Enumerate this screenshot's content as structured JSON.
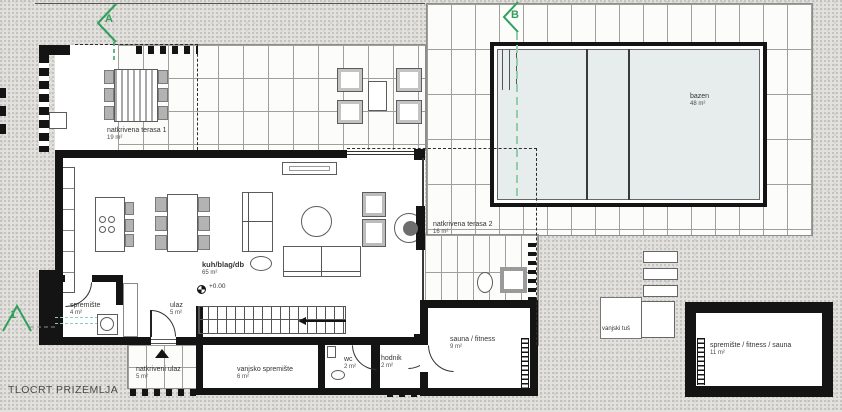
{
  "drawing": {
    "title": "TLOCRT PRIZEMLJA",
    "elevation_label": "+0.00"
  },
  "section_markers": {
    "a": "A",
    "b": "B",
    "one": "1"
  },
  "rooms": {
    "terasa1": {
      "name": "natkrivena terasa 1",
      "area": "19 m²"
    },
    "bazen": {
      "name": "bazen",
      "area": "48 m²"
    },
    "living": {
      "name": "kuh/blag/db",
      "area": "65 m²"
    },
    "terasa2": {
      "name": "natkrivena terasa 2",
      "area": "16 m²"
    },
    "spremiste": {
      "name": "spremište",
      "area": "4 m²"
    },
    "ulaz": {
      "name": "ulaz",
      "area": "5 m²"
    },
    "natkriveni_ulaz": {
      "name": "natkriveni ulaz",
      "area": "5 m²"
    },
    "vanjsko_spremiste": {
      "name": "vanjsko spremište",
      "area": "6 m²"
    },
    "wc": {
      "name": "wc",
      "area": "2 m²"
    },
    "hodnik": {
      "name": "hodnik",
      "area": "2 m²"
    },
    "sauna_fitness": {
      "name": "sauna / fitness",
      "area": "9 m²"
    },
    "vanjski_tus": {
      "name": "vanjski tuš"
    },
    "spremiste_fitness_sauna": {
      "name": "spremište / fitness / sauna",
      "area": "11 m²"
    }
  },
  "colors": {
    "section_green": "#2fa05c",
    "section_green_light": "#8fcfa9",
    "pool_water": "#e6edec",
    "wall_black": "#141414"
  }
}
